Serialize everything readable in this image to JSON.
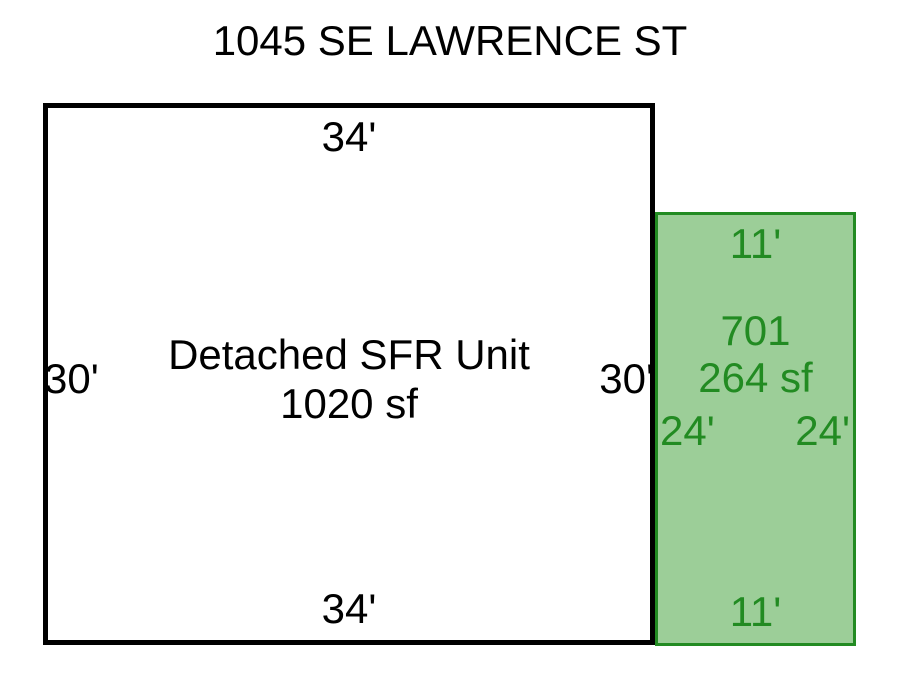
{
  "title": "1045 SE LAWRENCE ST",
  "colors": {
    "green_border": "#228B22",
    "green_fill": "#9CCE98",
    "green_text": "#228B22",
    "main_border": "#000000",
    "text": "#000000"
  },
  "main_unit": {
    "name": "Detached SFR Unit",
    "area": "1020 sf",
    "dim_top": "34'",
    "dim_bottom": "34'",
    "dim_left": "30'",
    "dim_right": "30'"
  },
  "addition": {
    "id": "701",
    "area": "264 sf",
    "dim_top": "11'",
    "dim_bottom": "11'",
    "dim_left": "24'",
    "dim_right": "24'"
  }
}
